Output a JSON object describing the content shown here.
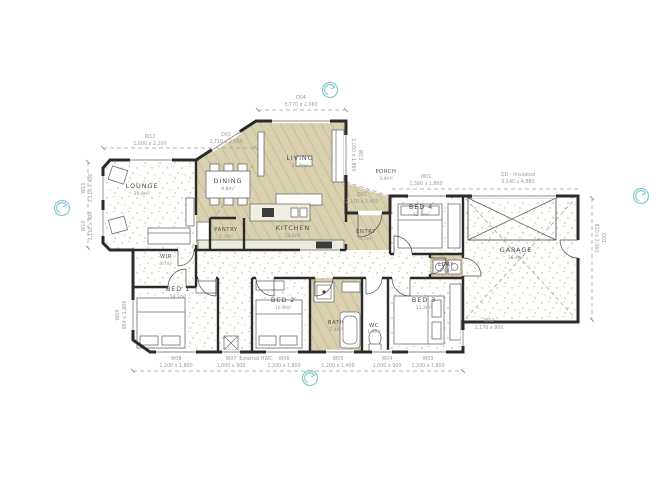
{
  "colors": {
    "wall": "#2b2b2b",
    "floor_wood": "#d8cfae",
    "dim": "#9b9b9b",
    "teal": "#8bc7d5"
  },
  "rooms": {
    "lounge": {
      "name": "LOUNGE",
      "area": "20.8m²"
    },
    "dining": {
      "name": "DINING",
      "area": "9.8m²"
    },
    "living": {
      "name": "LIVING",
      "area": "21.4m²"
    },
    "kitchen": {
      "name": "KITCHEN",
      "area": "13.6m²"
    },
    "pantry": {
      "name": "PANTRY",
      "area": "1.7m²"
    },
    "entry": {
      "name": "ENTRY",
      "area": "4.7m²"
    },
    "porch": {
      "name": "PORCH",
      "area": "3.4m²"
    },
    "bed1": {
      "name": "BED 1",
      "area": "14.2m²"
    },
    "bed2": {
      "name": "BED 2",
      "area": "10.9m²"
    },
    "bed3": {
      "name": "BED 3",
      "area": "11.2m²"
    },
    "bed4": {
      "name": "BED 4",
      "area": "12.4m²"
    },
    "bath": {
      "name": "BATH",
      "area": "7.4m²"
    },
    "wc": {
      "name": "WC",
      "area": "1.9m²"
    },
    "wir": {
      "name": "WIR",
      "area": "4.7m²"
    },
    "ldry": {
      "name": "LDRY",
      "area": "2.9m²"
    },
    "garage": {
      "name": "GARAGE",
      "area": "36.4m²"
    }
  },
  "openings": {
    "w12": {
      "code": "W12",
      "size": "1,000 x 2,200"
    },
    "d03": {
      "code": "D03",
      "size": "2,710 x 2,060"
    },
    "d04": {
      "code": "D04",
      "size": "3,770 x 2,060"
    },
    "w13": {
      "code": "W13",
      "size": "1,060 x 1,860"
    },
    "w11": {
      "code": "W11",
      "size": "2,110 x 400"
    },
    "w10": {
      "code": "W10",
      "size": "2,110 x 400"
    },
    "w09": {
      "code": "W09",
      "size": "954 x 1,800"
    },
    "d02": {
      "code": "D02",
      "size": "2,170 x 1,400"
    },
    "w01": {
      "code": "W01",
      "size": "1,380 x 1,800"
    },
    "gd": {
      "code": "GD - insulated",
      "size": "5,140 x 4,880"
    },
    "d01": {
      "code": "D01",
      "size": "810 x 2,060"
    },
    "w02": {
      "code": "W02",
      "size": "1,170 x 900"
    },
    "w08": {
      "code": "W08",
      "size": "1,200 x 1,800"
    },
    "w07": {
      "code": "W07",
      "size": "1,000 x 900"
    },
    "w06": {
      "code": "W06",
      "size": "1,200 x 1,800"
    },
    "w05": {
      "code": "W05",
      "size": "1,200 x 1,400"
    },
    "w04": {
      "code": "W04",
      "size": "1,000 x 900"
    },
    "w03": {
      "code": "W03",
      "size": "1,200 x 1,800"
    }
  },
  "notes": {
    "hwc": "External HWC"
  }
}
